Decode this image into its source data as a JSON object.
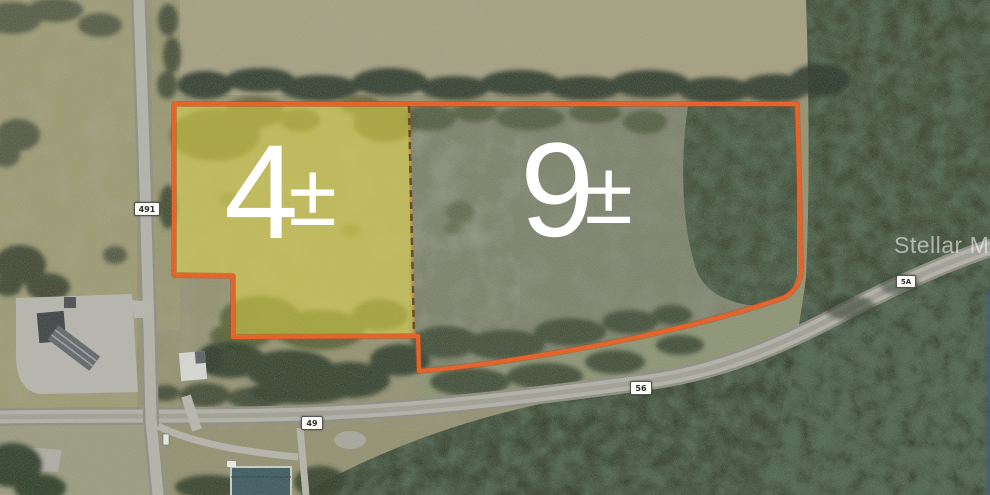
{
  "map": {
    "type": "aerial-satellite-parcel-map",
    "parcels": [
      {
        "id": "west-parcel",
        "acreage": "4",
        "plus_minus": "±",
        "highlighted": true,
        "highlight_color": "#e3d84f",
        "outline_color": "#ea5a1d",
        "divider_style": "dashed"
      },
      {
        "id": "east-parcel",
        "acreage": "9",
        "plus_minus": "±",
        "highlighted": false,
        "outline_color": "#ea5a1d"
      }
    ],
    "road_labels": [
      {
        "text": "491"
      },
      {
        "text": "49"
      },
      {
        "text": "56"
      },
      {
        "text": "5A"
      }
    ],
    "label_text_color": "#ffffff"
  },
  "watermark": {
    "text": "Stellar MLS",
    "color": "#ffffff",
    "opacity": 0.55
  }
}
